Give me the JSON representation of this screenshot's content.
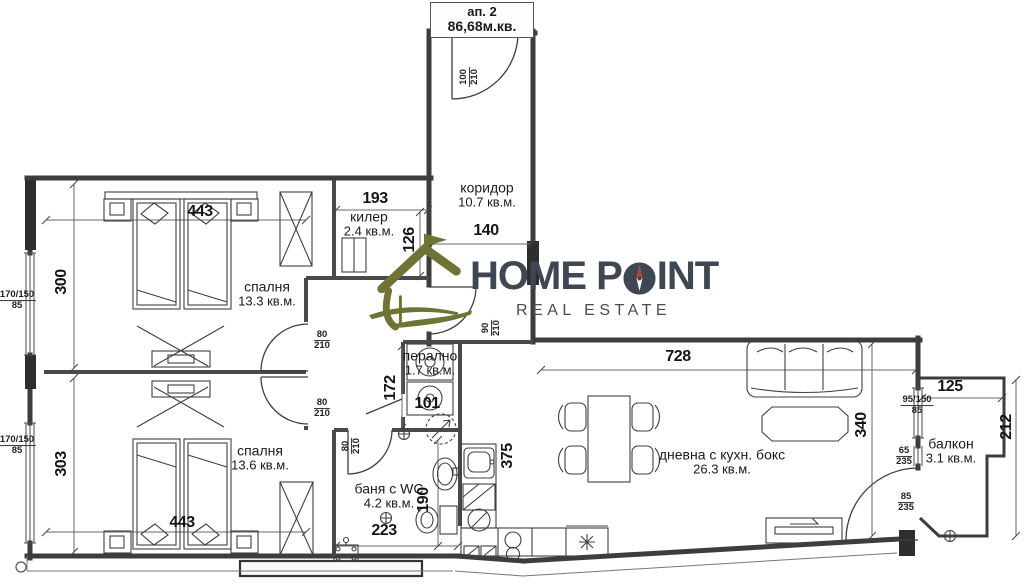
{
  "apartment": {
    "label": "ап. 2",
    "area": "86,68м.кв."
  },
  "brand": {
    "pre": "HOME P",
    "post": "INT",
    "tagline": "REAL ESTATE"
  },
  "rooms": [
    {
      "name": "спалня",
      "area": "13.3 кв.м."
    },
    {
      "name": "спалня",
      "area": "13.6 кв.м."
    },
    {
      "name": "килер",
      "area": "2.4 кв.м."
    },
    {
      "name": "коридор",
      "area": "10.7 кв.м."
    },
    {
      "name": "перално",
      "area": "1.7 кв.м."
    },
    {
      "name": "баня с WC",
      "area": "4.2 кв.м."
    },
    {
      "name": "дневна с кухн. бокс",
      "area": "26.3 кв.м."
    },
    {
      "name": "балкон",
      "area": "3.1 кв.м."
    }
  ],
  "dims": {
    "bedroom1_width": "443",
    "bedroom1_depth": "300",
    "bedroom2_width": "443",
    "bedroom2_depth": "303",
    "closet_width": "193",
    "closet_depth": "126",
    "corridor_width": "140",
    "laundry_depth": "172",
    "laundry_width": "101",
    "bath_width": "223",
    "bath_depth": "190",
    "kitchen_run": "375",
    "living_width": "728",
    "living_depth": "340",
    "balcony_width": "125",
    "balcony_depth": "212"
  },
  "openings": {
    "entry_door": {
      "top": "100",
      "bottom": "210"
    },
    "hall_door": {
      "top": "90",
      "bottom": "210"
    },
    "interior_door": {
      "top": "80",
      "bottom": "210"
    },
    "window_left": {
      "top": "170/150",
      "bottom": "85"
    },
    "balcony_window": {
      "top": "95/150",
      "bottom": "85"
    },
    "balcony_opening_small": {
      "top": "65",
      "bottom": "235"
    },
    "balcony_door": {
      "top": "85",
      "bottom": "235"
    }
  },
  "colors": {
    "line": "#3d3d3d",
    "logo_olive": "#6f7336",
    "logo_dark": "#3f4753",
    "compass_red": "#c23b2f"
  }
}
